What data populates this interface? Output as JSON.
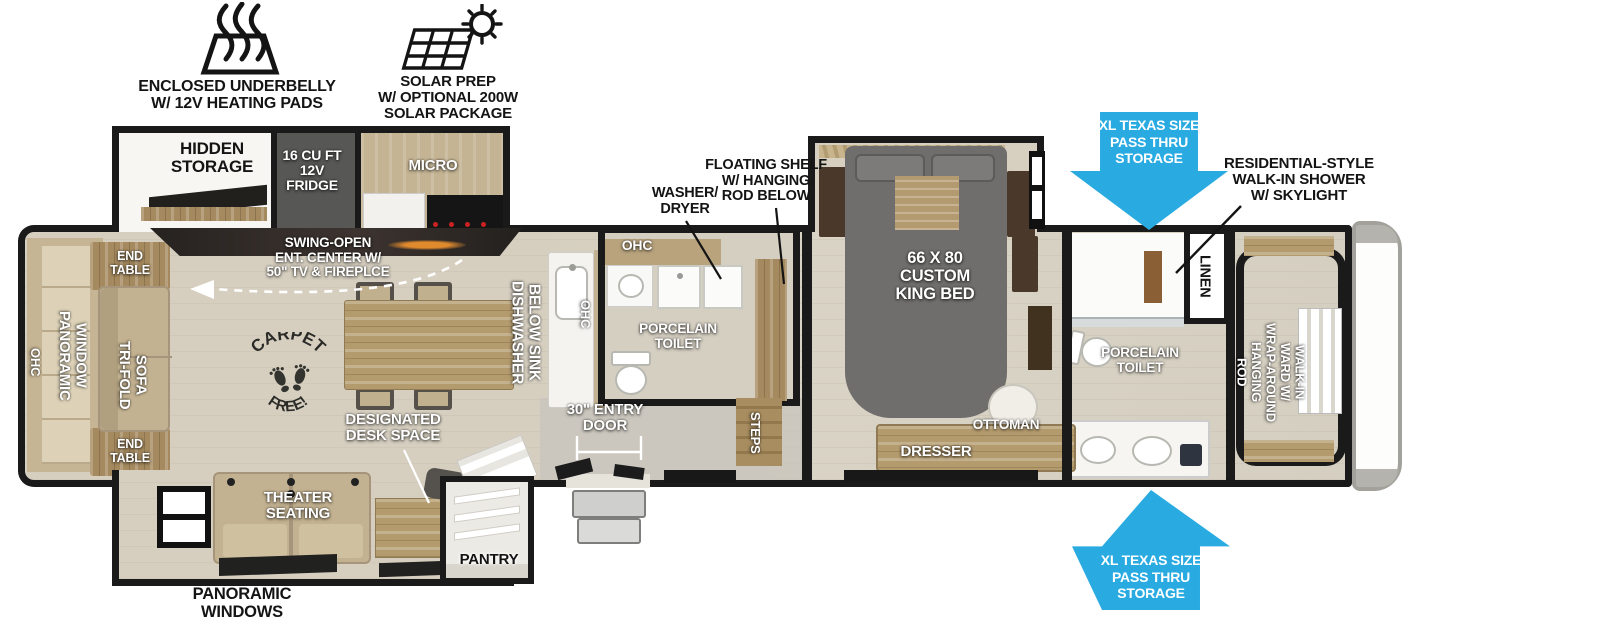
{
  "colors": {
    "accent_blue": "#29ABE2",
    "wall": "#1a1a1a",
    "floor": "#d8d1c2"
  },
  "icons": {
    "underbelly": "heat-waves-icon",
    "solar": "solar-panel-sun-icon",
    "carpet": "carpet-free-stamp"
  },
  "badges": {
    "underbelly": "ENCLOSED UNDERBELLY\nW/ 12V HEATING PADS",
    "solar": "SOLAR PREP\nW/ OPTIONAL 200W\nSOLAR PACKAGE"
  },
  "pass_thru": {
    "top": "XL TEXAS SIZE\nPASS THRU\nSTORAGE",
    "bottom": "XL TEXAS SIZE\nPASS THRU\nSTORAGE"
  },
  "kitchen_slide": {
    "hidden_storage": "HIDDEN\nSTORAGE",
    "fridge": "16 CU FT\n12V\nFRIDGE",
    "micro": "MICRO"
  },
  "living": {
    "ent_center": "SWING-OPEN\nENT. CENTER W/\n50\" TV & FIREPLCE",
    "end_table_top": "END\nTABLE",
    "end_table_bottom": "END\nTABLE",
    "ohc": "OHC",
    "panoramic_window": "PANORAMIC\nWINDOW",
    "trifold_sofa": "TRI-FOLD\nSOFA",
    "carpet_top": "CARPET",
    "carpet_bottom": "FREE!",
    "desk": "DESIGNATED\nDESK SPACE",
    "theater": "THEATER\nSEATING",
    "pantry": "PANTRY",
    "panoramic_windows": "PANORAMIC\nWINDOWS"
  },
  "kitchen": {
    "dishwasher": "DISHWASHER\nBELOW SINK",
    "ohc": "OHC",
    "entry_door": "30\" ENTRY\nDOOR",
    "steps": "STEPS"
  },
  "mid_bath": {
    "ohc": "OHC",
    "washer_dryer": "WASHER/\nDRYER",
    "floating_shelf": "FLOATING SHELF\nW/ HANGING\nROD BELOW",
    "toilet": "PORCELAIN\nTOILET"
  },
  "bedroom": {
    "bed": "66 X 80\nCUSTOM\nKING BED",
    "ottoman": "OTTOMAN",
    "dresser": "DRESSER"
  },
  "front_bath": {
    "shower": "RESIDENTIAL-STYLE\nWALK-IN SHOWER\nW/ SKYLIGHT",
    "linen": "LINEN",
    "toilet": "PORCELAIN\nTOILET",
    "walkin_ward": "WALK-IN\nWARD W/\nWRAP-AROUND\nHANGING\nROD"
  }
}
